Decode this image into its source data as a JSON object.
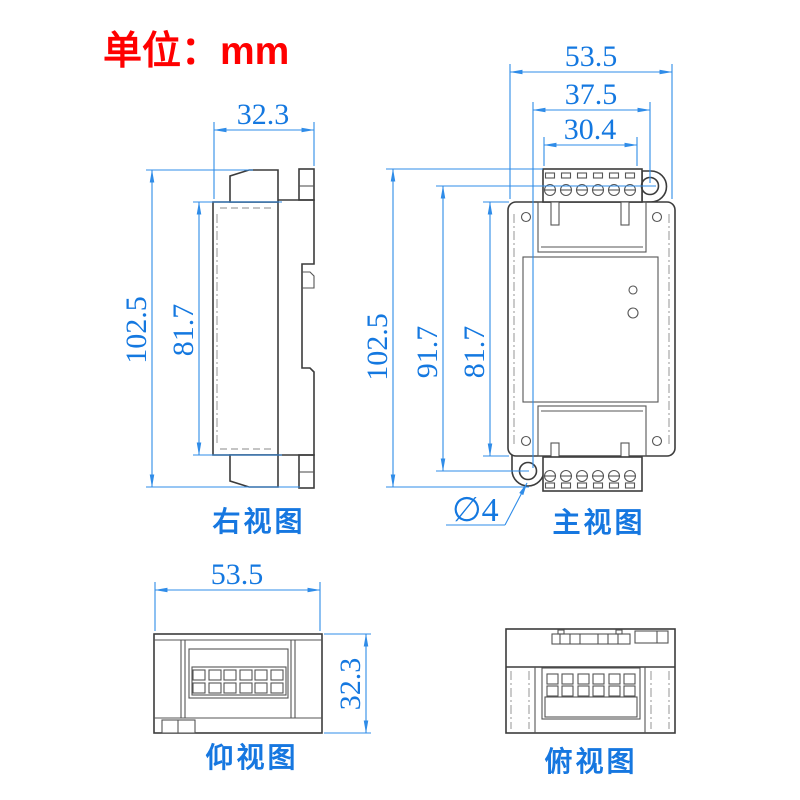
{
  "title": {
    "unit_label": "单位：mm"
  },
  "colors": {
    "dimension_blue": "#1478e0",
    "drawing_gray": "#3c3c3c",
    "unit_red": "#ff0000",
    "background": "#ffffff"
  },
  "views": {
    "right": {
      "label": "右视图",
      "dim_width": "32.3",
      "dim_overall_height": "102.5",
      "dim_body_height": "81.7"
    },
    "front": {
      "label": "主视图",
      "dim_overall_width": "53.5",
      "dim_hole_span": "37.5",
      "dim_terminal_width": "30.4",
      "dim_overall_height": "102.5",
      "dim_hole_height": "91.7",
      "dim_body_height": "81.7",
      "dim_hole_diameter": "∅4"
    },
    "bottom": {
      "label": "仰视图",
      "dim_width": "53.5",
      "dim_depth": "32.3"
    },
    "top": {
      "label": "俯视图"
    }
  }
}
